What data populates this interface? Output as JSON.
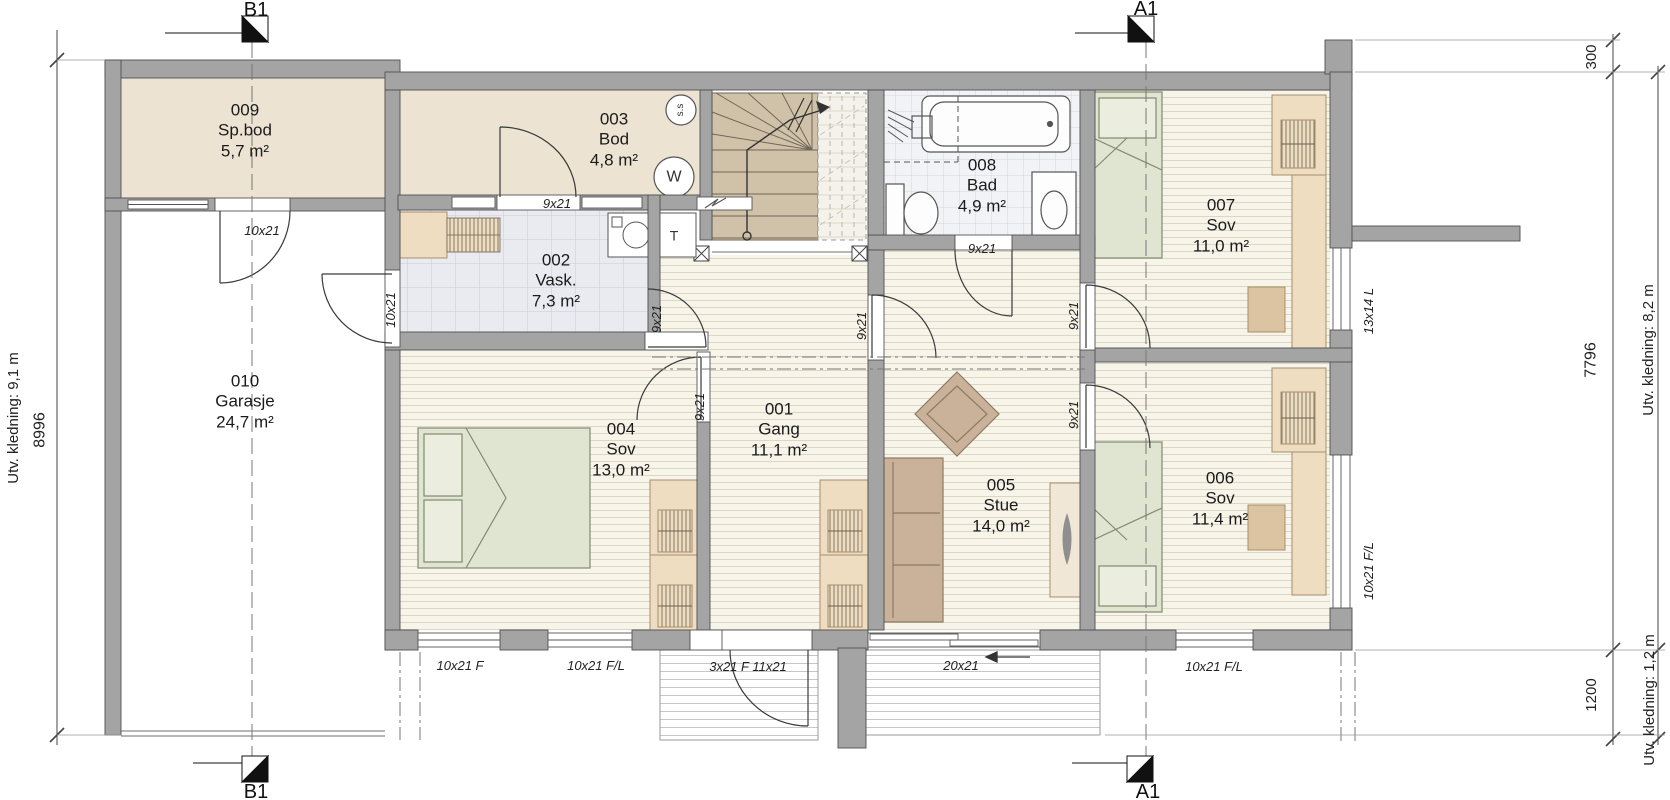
{
  "rooms": [
    {
      "number": "001",
      "name": "Gang",
      "area": "11,1 m²"
    },
    {
      "number": "002",
      "name": "Vask.",
      "area": "7,3 m²"
    },
    {
      "number": "003",
      "name": "Bod",
      "area": "4,8 m²"
    },
    {
      "number": "004",
      "name": "Sov",
      "area": "13,0 m²"
    },
    {
      "number": "005",
      "name": "Stue",
      "area": "14,0 m²"
    },
    {
      "number": "006",
      "name": "Sov",
      "area": "11,4 m²"
    },
    {
      "number": "007",
      "name": "Sov",
      "area": "11,0 m²"
    },
    {
      "number": "008",
      "name": "Bad",
      "area": "4,9 m²"
    },
    {
      "number": "009",
      "name": "Sp.bod",
      "area": "5,7 m²"
    },
    {
      "number": "010",
      "name": "Garasje",
      "area": "24,7 m²"
    }
  ],
  "sections": {
    "a": "A1",
    "b": "B1"
  },
  "dimensions": {
    "left_total": "8996",
    "left_cladding": "Utv. kledning: 9,1 m",
    "right_top": "300",
    "right_main": "7796",
    "right_bottom": "1200",
    "right_cladding_main": "Utv. kledning: 8,2 m",
    "right_cladding_bottom": "Utv. kledning: 1,2 m"
  },
  "openings": {
    "spbod_door": "10x21",
    "garage_side_door": "10x21",
    "bod_door": "9x21",
    "vask_door": "9x21",
    "bad_door": "9x21",
    "stue_door": "9x21",
    "sov7_door": "9x21",
    "sov4_door": "9x21",
    "sov6_door": "9x21",
    "window_13x14": "13x14 L",
    "window_right_006": "10x21 F/L",
    "window_bottom_1": "10x21 F",
    "window_bottom_2": "10x21 F/L",
    "entrance_door": "3x21 F 11x21",
    "sliding_door": "20x21",
    "window_bottom_3": "10x21 F/L"
  },
  "symbols": {
    "sprinkler": "s.s",
    "water_heater": "W",
    "dryer": "T"
  },
  "colors": {
    "wall": "#a4a4a4",
    "floor_beige": "#ece3d2",
    "floor_wood": "#f7f4ea",
    "tile_vask": "#e9ebf0",
    "tile_bad": "#f2f3f6",
    "bed_green": "#dfe5d1",
    "furniture_tan": "#eeddc1",
    "stair_tan": "#d0c2a8",
    "sofa": "#c9b19a"
  }
}
